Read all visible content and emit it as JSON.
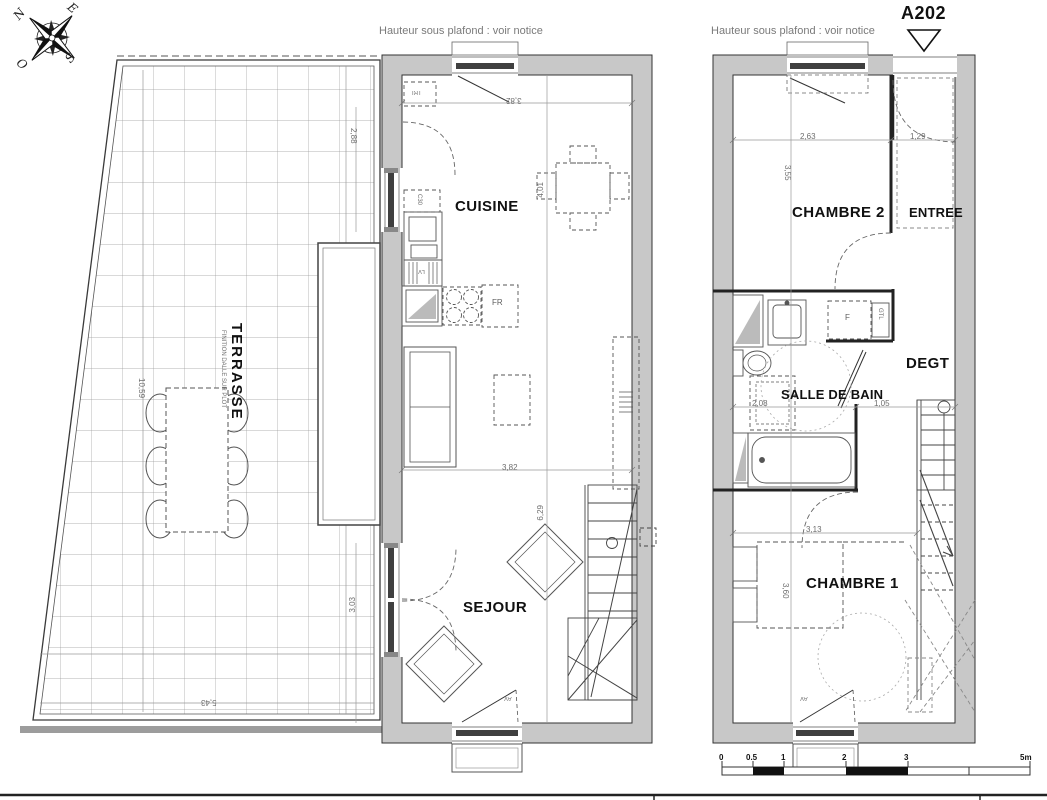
{
  "header": {
    "ceiling_note_left": "Hauteur sous plafond : voir notice",
    "ceiling_note_right": "Hauteur sous plafond : voir notice",
    "unit_label": "A202"
  },
  "compass": {
    "n": "N",
    "e": "E",
    "s": "S",
    "o": "O"
  },
  "left_plan": {
    "rooms": {
      "cuisine": "CUISINE",
      "sejour": "SEJOUR",
      "terrasse": "TERRASSE",
      "terrasse_note": "FINITION DALLE SUR PLOT"
    },
    "tags": {
      "tri": "TRI",
      "c30": "C30",
      "lv": "LV",
      "fr": "FR",
      "av": "AV"
    },
    "dims": {
      "width_top": "3,82",
      "width_mid": "3,82",
      "kitchen_depth": "4,01",
      "sejour_depth": "6,29",
      "kitchen_window": "2,88",
      "sejour_window": "3,03",
      "terrace_length": "10,59",
      "terrace_width": "5,43"
    }
  },
  "right_plan": {
    "rooms": {
      "chambre2": "CHAMBRE 2",
      "entree": "ENTREE",
      "degt": "DEGT",
      "salle_de_bain": "SALLE DE BAIN",
      "chambre1": "CHAMBRE 1"
    },
    "tags": {
      "f": "F",
      "gtl": "GTL",
      "av": "AV"
    },
    "dims": {
      "chambre2_width": "2,63",
      "entree_width": "1,29",
      "chambre2_depth": "3,55",
      "sdb_width": "2,08",
      "degt_width": "1,05",
      "chambre1_width": "3,13",
      "chambre1_depth": "3,60"
    }
  },
  "scale_bar": {
    "t0": "0",
    "t05": "0.5",
    "t1": "1",
    "t2": "2",
    "t3": "3",
    "t5": "5m"
  },
  "colors": {
    "wall_fill": "#c8c8c8",
    "line": "#3a3a3a",
    "dim_text": "#6e6e6e"
  }
}
